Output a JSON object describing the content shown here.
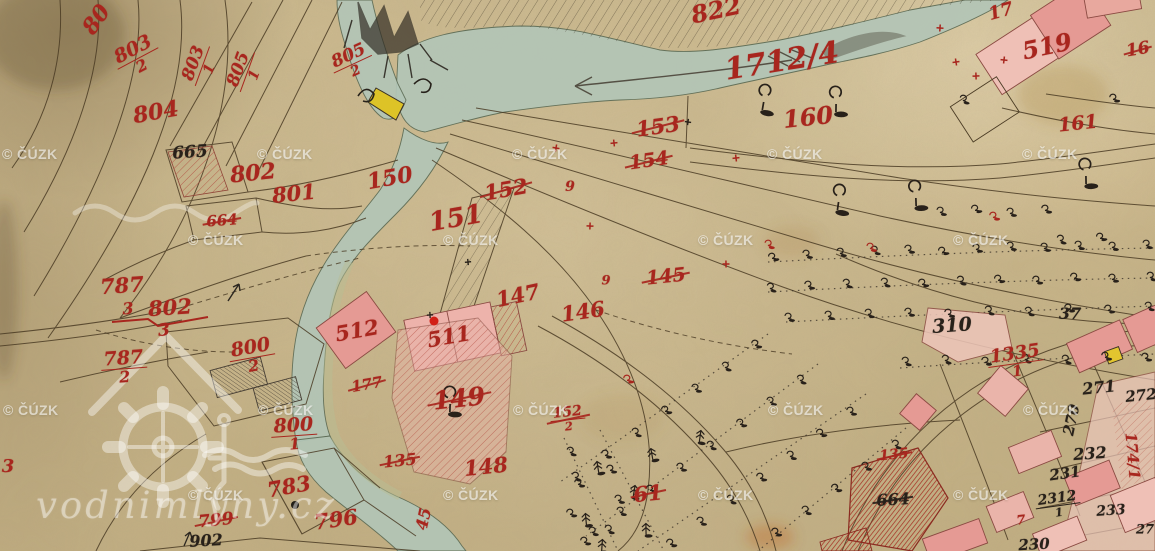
{
  "watermark": {
    "text": "© ČÚZK",
    "positions": [
      [
        2,
        146
      ],
      [
        257,
        146
      ],
      [
        512,
        146
      ],
      [
        767,
        146
      ],
      [
        1022,
        146
      ],
      [
        188,
        232
      ],
      [
        443,
        232
      ],
      [
        698,
        232
      ],
      [
        953,
        232
      ],
      [
        3,
        402
      ],
      [
        258,
        402
      ],
      [
        513,
        402
      ],
      [
        768,
        402
      ],
      [
        1023,
        402
      ],
      [
        188,
        487
      ],
      [
        443,
        487
      ],
      [
        698,
        487
      ],
      [
        953,
        487
      ]
    ]
  },
  "logo": {
    "text": "vodnimlyny.cz"
  },
  "map": {
    "ink_red": "#a8261e",
    "ink_black": "#28211a",
    "river_color": "#b2c5b7",
    "building_pink": "#e59a94",
    "highlight_yellow": "#e2c52f",
    "labels": [
      {
        "t": "80",
        "x": 97,
        "y": 20,
        "r": -55,
        "s": 22
      },
      {
        "t": "803/2",
        "x": 137,
        "y": 57,
        "r": -28,
        "s": 19,
        "sk": 1
      },
      {
        "t": "803/1",
        "x": 201,
        "y": 66,
        "r": -70,
        "s": 17,
        "sk": 1
      },
      {
        "t": "805/1",
        "x": 246,
        "y": 72,
        "r": -70,
        "s": 17,
        "sk": 1
      },
      {
        "t": "805/2",
        "x": 352,
        "y": 63,
        "r": -25,
        "s": 17,
        "sk": 1
      },
      {
        "t": "804",
        "x": 156,
        "y": 113,
        "r": -10,
        "s": 22
      },
      {
        "t": "665",
        "x": 190,
        "y": 153,
        "r": -4,
        "s": 17,
        "c": "k"
      },
      {
        "t": "802",
        "x": 253,
        "y": 174,
        "r": -6,
        "s": 22
      },
      {
        "t": "801",
        "x": 294,
        "y": 194,
        "r": -6,
        "s": 21
      },
      {
        "t": "664",
        "x": 222,
        "y": 221,
        "r": -4,
        "s": 15,
        "st": 1
      },
      {
        "t": "150",
        "x": 390,
        "y": 179,
        "r": -10,
        "s": 22
      },
      {
        "t": "151",
        "x": 456,
        "y": 219,
        "r": -10,
        "s": 26
      },
      {
        "t": "152",
        "x": 506,
        "y": 190,
        "r": -10,
        "s": 21,
        "st": 1
      },
      {
        "t": "9",
        "x": 570,
        "y": 187,
        "r": 0,
        "s": 14
      },
      {
        "t": "153",
        "x": 658,
        "y": 127,
        "r": -8,
        "s": 21,
        "st": 1
      },
      {
        "t": "154",
        "x": 649,
        "y": 161,
        "r": -8,
        "s": 19,
        "st": 1
      },
      {
        "t": "1712/4",
        "x": 782,
        "y": 62,
        "r": -9,
        "s": 30
      },
      {
        "t": "822",
        "x": 716,
        "y": 10,
        "r": -12,
        "s": 24
      },
      {
        "t": "17",
        "x": 1001,
        "y": 12,
        "r": -15,
        "s": 18
      },
      {
        "t": "519",
        "x": 1047,
        "y": 46,
        "r": -12,
        "s": 24
      },
      {
        "t": "16",
        "x": 1138,
        "y": 50,
        "r": -10,
        "s": 17,
        "st": 1
      },
      {
        "t": "160",
        "x": 808,
        "y": 117,
        "r": -6,
        "s": 24
      },
      {
        "t": "161",
        "x": 1078,
        "y": 124,
        "r": -6,
        "s": 19
      },
      {
        "t": "145",
        "x": 666,
        "y": 277,
        "r": -6,
        "s": 19,
        "st": 1
      },
      {
        "t": "9",
        "x": 606,
        "y": 281,
        "r": 0,
        "s": 13
      },
      {
        "t": "147",
        "x": 518,
        "y": 296,
        "r": -12,
        "s": 21
      },
      {
        "t": "146",
        "x": 583,
        "y": 312,
        "r": -8,
        "s": 21
      },
      {
        "t": "787",
        "x": 122,
        "y": 286,
        "r": -4,
        "s": 21
      },
      {
        "t": "3",
        "x": 128,
        "y": 309,
        "r": -4,
        "s": 16
      },
      {
        "t": "802",
        "x": 170,
        "y": 308,
        "r": -4,
        "s": 21
      },
      {
        "t": "3",
        "x": 164,
        "y": 331,
        "r": -4,
        "s": 17
      },
      {
        "t": "787/2",
        "x": 124,
        "y": 367,
        "r": -4,
        "s": 19,
        "sk": 1
      },
      {
        "t": "800/2",
        "x": 252,
        "y": 356,
        "r": -10,
        "s": 19,
        "sk": 1
      },
      {
        "t": "800/1",
        "x": 294,
        "y": 434,
        "r": -4,
        "s": 19,
        "sk": 1
      },
      {
        "t": "3",
        "x": 8,
        "y": 467,
        "r": 0,
        "s": 18
      },
      {
        "t": "512",
        "x": 357,
        "y": 331,
        "r": -10,
        "s": 21
      },
      {
        "t": "511",
        "x": 449,
        "y": 337,
        "r": -10,
        "s": 21
      },
      {
        "t": "177",
        "x": 367,
        "y": 385,
        "r": -10,
        "s": 15,
        "st": 1
      },
      {
        "t": "149",
        "x": 459,
        "y": 399,
        "r": -6,
        "s": 25,
        "st": 1
      },
      {
        "t": "135",
        "x": 400,
        "y": 461,
        "r": -6,
        "s": 16,
        "st": 1
      },
      {
        "t": "148",
        "x": 486,
        "y": 467,
        "r": -6,
        "s": 21
      },
      {
        "t": "152/2",
        "x": 568,
        "y": 419,
        "r": -6,
        "s": 14,
        "st": 1,
        "sk": 1
      },
      {
        "t": "45",
        "x": 424,
        "y": 519,
        "r": -78,
        "s": 16
      },
      {
        "t": "61",
        "x": 648,
        "y": 494,
        "r": -6,
        "s": 21,
        "st": 1
      },
      {
        "t": "783",
        "x": 289,
        "y": 487,
        "r": -10,
        "s": 21
      },
      {
        "t": "796",
        "x": 336,
        "y": 520,
        "r": -8,
        "s": 21
      },
      {
        "t": "799",
        "x": 216,
        "y": 521,
        "r": -6,
        "s": 17,
        "st": 1
      },
      {
        "t": "902",
        "x": 206,
        "y": 541,
        "r": -3,
        "s": 16,
        "c": "k"
      },
      {
        "t": "310",
        "x": 952,
        "y": 326,
        "r": -4,
        "s": 19,
        "c": "k"
      },
      {
        "t": "37",
        "x": 1070,
        "y": 314,
        "r": 0,
        "s": 16,
        "c": "k"
      },
      {
        "t": "1335/1",
        "x": 1016,
        "y": 362,
        "r": -8,
        "s": 18,
        "sk": 1
      },
      {
        "t": "135",
        "x": 894,
        "y": 455,
        "r": -6,
        "s": 14,
        "st": 1
      },
      {
        "t": "664",
        "x": 893,
        "y": 500,
        "r": -3,
        "s": 16,
        "c": "k",
        "st": 1
      },
      {
        "t": "271",
        "x": 1099,
        "y": 388,
        "r": -6,
        "s": 16,
        "c": "k"
      },
      {
        "t": "272",
        "x": 1141,
        "y": 396,
        "r": -6,
        "s": 15,
        "c": "k"
      },
      {
        "t": "270",
        "x": 1072,
        "y": 420,
        "r": -78,
        "s": 15,
        "c": "k"
      },
      {
        "t": "232",
        "x": 1090,
        "y": 454,
        "r": -4,
        "s": 16,
        "c": "k"
      },
      {
        "t": "231",
        "x": 1065,
        "y": 474,
        "r": -8,
        "s": 15,
        "c": "k"
      },
      {
        "t": "2312/1",
        "x": 1058,
        "y": 505,
        "r": -8,
        "s": 14,
        "c": "k",
        "sk": 1
      },
      {
        "t": "233",
        "x": 1111,
        "y": 511,
        "r": -4,
        "s": 14,
        "c": "k"
      },
      {
        "t": "230",
        "x": 1034,
        "y": 545,
        "r": -3,
        "s": 15,
        "c": "k"
      },
      {
        "t": "174/1",
        "x": 1132,
        "y": 456,
        "r": 85,
        "s": 15
      },
      {
        "t": "27",
        "x": 1145,
        "y": 530,
        "r": 0,
        "s": 13,
        "c": "k"
      },
      {
        "t": "7",
        "x": 1021,
        "y": 521,
        "r": -6,
        "s": 13
      }
    ],
    "trees": {
      "tree": [
        [
          763,
          106
        ],
        [
          836,
          108
        ],
        [
          838,
          206
        ],
        [
          916,
          202
        ],
        [
          1086,
          180
        ],
        [
          450,
          408
        ]
      ],
      "bush": [
        [
          772,
          258
        ],
        [
          806,
          255
        ],
        [
          840,
          253
        ],
        [
          874,
          251
        ],
        [
          908,
          250
        ],
        [
          942,
          252
        ],
        [
          976,
          249
        ],
        [
          1010,
          247
        ],
        [
          1044,
          248
        ],
        [
          1078,
          246
        ],
        [
          1112,
          247
        ],
        [
          1146,
          245
        ],
        [
          770,
          288
        ],
        [
          808,
          286
        ],
        [
          846,
          284
        ],
        [
          884,
          283
        ],
        [
          922,
          284
        ],
        [
          960,
          281
        ],
        [
          998,
          280
        ],
        [
          1036,
          281
        ],
        [
          1074,
          278
        ],
        [
          1112,
          279
        ],
        [
          1150,
          277
        ],
        [
          788,
          318
        ],
        [
          828,
          316
        ],
        [
          868,
          314
        ],
        [
          908,
          313
        ],
        [
          948,
          314
        ],
        [
          988,
          311
        ],
        [
          1028,
          312
        ],
        [
          1068,
          309
        ],
        [
          1108,
          310
        ],
        [
          1148,
          307
        ],
        [
          905,
          362
        ],
        [
          945,
          360
        ],
        [
          985,
          362
        ],
        [
          1025,
          359
        ],
        [
          1065,
          360
        ],
        [
          1105,
          357
        ],
        [
          1145,
          358
        ],
        [
          963,
          100
        ],
        [
          1113,
          99
        ],
        [
          940,
          212
        ],
        [
          975,
          210
        ],
        [
          1010,
          213
        ],
        [
          1045,
          210
        ],
        [
          1060,
          240
        ],
        [
          1100,
          238
        ],
        [
          755,
          345
        ],
        [
          725,
          367
        ],
        [
          695,
          389
        ],
        [
          665,
          411
        ],
        [
          635,
          433
        ],
        [
          605,
          455
        ],
        [
          575,
          477
        ],
        [
          800,
          380
        ],
        [
          770,
          402
        ],
        [
          740,
          424
        ],
        [
          710,
          446
        ],
        [
          680,
          468
        ],
        [
          650,
          490
        ],
        [
          620,
          512
        ],
        [
          592,
          532
        ],
        [
          850,
          412
        ],
        [
          820,
          434
        ],
        [
          790,
          456
        ],
        [
          760,
          478
        ],
        [
          730,
          500
        ],
        [
          700,
          522
        ],
        [
          670,
          544
        ],
        [
          895,
          445
        ],
        [
          865,
          467
        ],
        [
          835,
          489
        ],
        [
          805,
          511
        ],
        [
          775,
          533
        ],
        [
          570,
          452
        ],
        [
          578,
          484
        ],
        [
          570,
          514
        ],
        [
          584,
          542
        ],
        [
          610,
          470
        ],
        [
          618,
          500
        ],
        [
          608,
          530
        ]
      ],
      "bush_red": [
        [
          768,
          245
        ],
        [
          870,
          248
        ],
        [
          993,
          217
        ],
        [
          627,
          380
        ]
      ],
      "conifer": [
        [
          598,
          468
        ],
        [
          634,
          492
        ],
        [
          586,
          520
        ],
        [
          652,
          455
        ],
        [
          700,
          437
        ],
        [
          646,
          530
        ],
        [
          602,
          546
        ]
      ]
    },
    "marks": {
      "crosses_red": [
        [
          556,
          148
        ],
        [
          614,
          143
        ],
        [
          736,
          158
        ],
        [
          590,
          226
        ],
        [
          726,
          264
        ],
        [
          940,
          28
        ],
        [
          956,
          62
        ],
        [
          976,
          76
        ],
        [
          1004,
          60
        ]
      ],
      "crosses_black": [
        [
          688,
          122
        ],
        [
          468,
          262
        ],
        [
          430,
          315
        ]
      ],
      "red_dot": [
        434,
        321
      ],
      "black_dot": [
        295,
        505
      ]
    }
  }
}
